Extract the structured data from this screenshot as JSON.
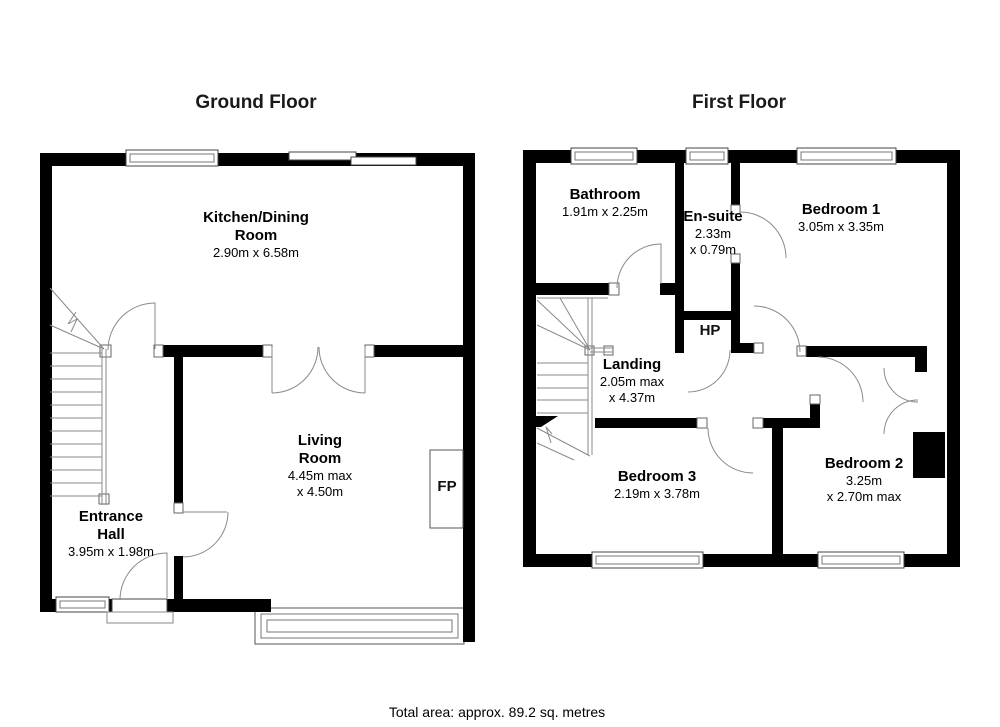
{
  "footer": {
    "total_area": "Total area: approx. 89.2 sq. metres"
  },
  "ground_floor": {
    "title": "Ground Floor",
    "rooms": {
      "kitchen": {
        "name1": "Kitchen/Dining",
        "name2": "Room",
        "dims": "2.90m x 6.58m"
      },
      "living": {
        "name1": "Living",
        "name2": "Room",
        "dims1": "4.45m max",
        "dims2": "x 4.50m"
      },
      "hall": {
        "name1": "Entrance",
        "name2": "Hall",
        "dims": "3.95m x 1.98m"
      },
      "fireplace": "FP"
    }
  },
  "first_floor": {
    "title": "First Floor",
    "rooms": {
      "bathroom": {
        "name": "Bathroom",
        "dims": "1.91m x 2.25m"
      },
      "ensuite": {
        "name": "En-suite",
        "dims1": "2.33m",
        "dims2": "x 0.79m"
      },
      "bedroom1": {
        "name": "Bedroom 1",
        "dims": "3.05m x 3.35m"
      },
      "hot_press": "HP",
      "landing": {
        "name": "Landing",
        "dims1": "2.05m max",
        "dims2": "x 4.37m"
      },
      "bedroom3": {
        "name": "Bedroom 3",
        "dims": "2.19m x 3.78m"
      },
      "bedroom2": {
        "name": "Bedroom 2",
        "dims1": "3.25m",
        "dims2": "x 2.70m max"
      }
    }
  }
}
